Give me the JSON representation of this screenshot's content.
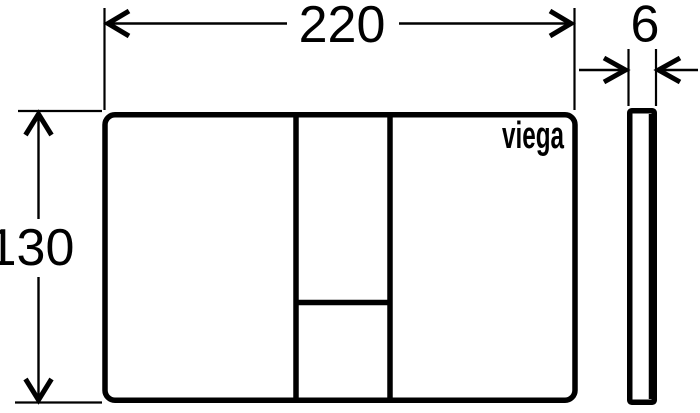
{
  "page": {
    "background_color": "#ffffff",
    "line_color": "#000000",
    "content": "technical dimension drawing of a flush plate, front view and side profile"
  },
  "front_view": {
    "logo_text": "viega"
  },
  "dimensions": {
    "width_label": "220",
    "height_label": "130",
    "thickness_label": "6"
  }
}
